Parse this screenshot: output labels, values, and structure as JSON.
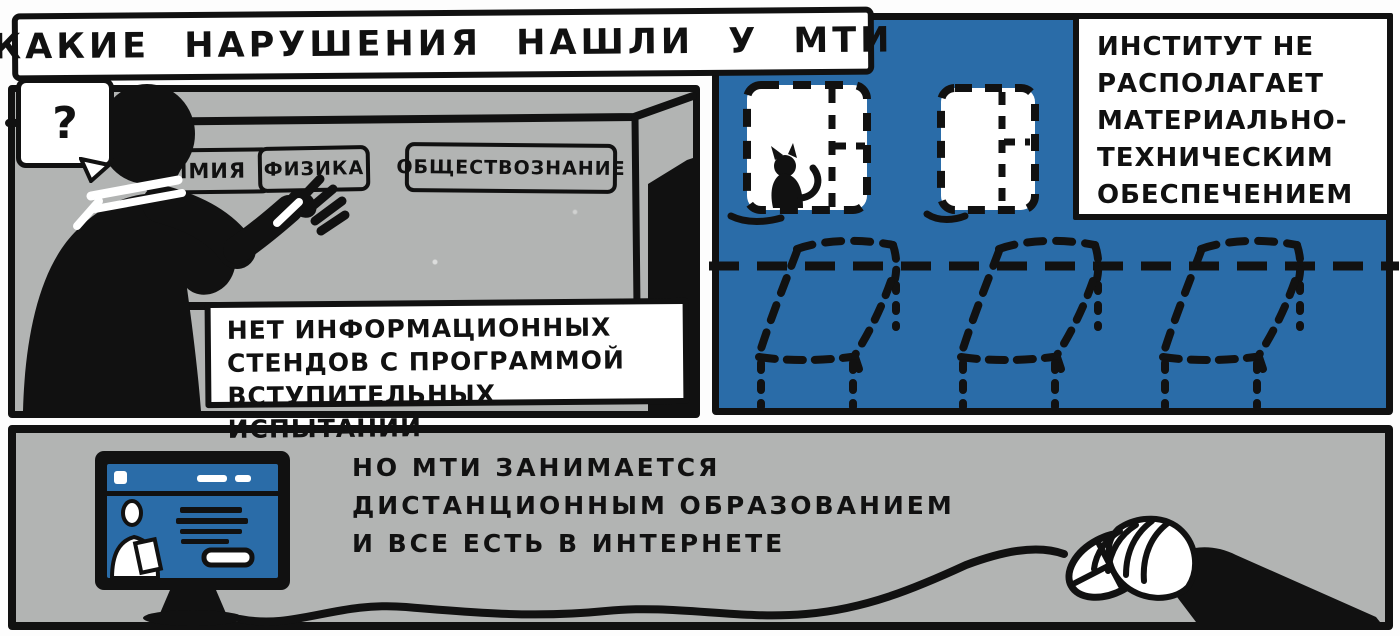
{
  "title": "КАКИЕ НАРУШЕНИЯ НАШЛИ У МТИ",
  "panels": {
    "classroom": {
      "bubble": "?",
      "plaques": [
        {
          "label": "ИМИЯ"
        },
        {
          "label": "ФИЗИКА"
        },
        {
          "label": "ОБЩЕСТВОЗНАНИЕ"
        }
      ],
      "caption": "НЕТ ИНФОРМАЦИОННЫХ\nСТЕНДОВ С ПРОГРАММОЙ\nВСТУПИТЕЛЬНЫХ ИСПЫТАНИЙ"
    },
    "empty_room": {
      "caption": "ИНСТИТУТ НЕ\nРАСПОЛАГАЕТ\nМАТЕРИАЛЬНО-\nТЕХНИЧЕСКИМ\nОБЕСПЕЧЕНИЕМ"
    },
    "online": {
      "caption": "НО МТИ ЗАНИМАЕТСЯ\nДИСТАНЦИОННЫМ ОБРАЗОВАНИЕМ\nИ ВСЕ ЕСТЬ В ИНТЕРНЕТЕ"
    }
  },
  "colors": {
    "blue": "#2a6ca8",
    "gray": "#b2b4b3",
    "ink": "#111111",
    "paper": "#fdfdfd"
  }
}
